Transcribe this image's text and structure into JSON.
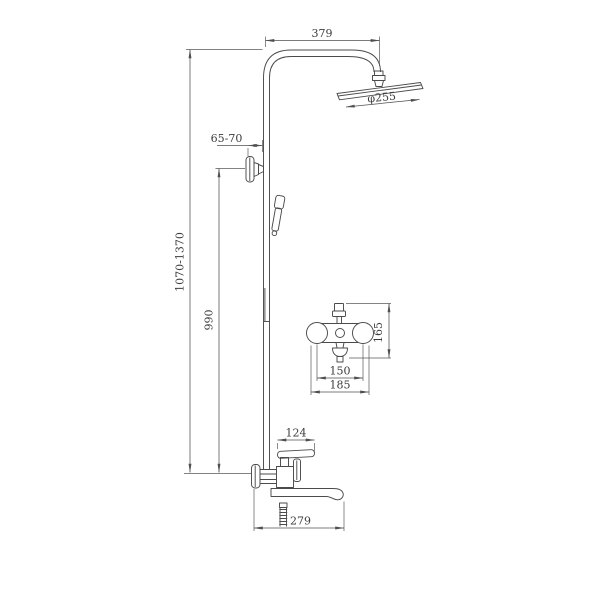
{
  "page": {
    "background": "#ffffff"
  },
  "colors": {
    "object_line": "#4b4b4b",
    "dimension_line": "#4f4f4f",
    "text": "#3c3c3c"
  },
  "dimensions": {
    "arm_reach": {
      "label": "379"
    },
    "head_diameter": {
      "label": "φ255"
    },
    "wall_offset": {
      "label": "65-70"
    },
    "overall_height": {
      "label": "1070-1370"
    },
    "riser_height": {
      "label": "990"
    },
    "mixer_height": {
      "label": "165"
    },
    "mixer_inlet_spacing": {
      "label": "150"
    },
    "mixer_overall_width": {
      "label": "185"
    },
    "handle_reach": {
      "label": "124"
    },
    "spout_reach": {
      "label": "279"
    }
  }
}
